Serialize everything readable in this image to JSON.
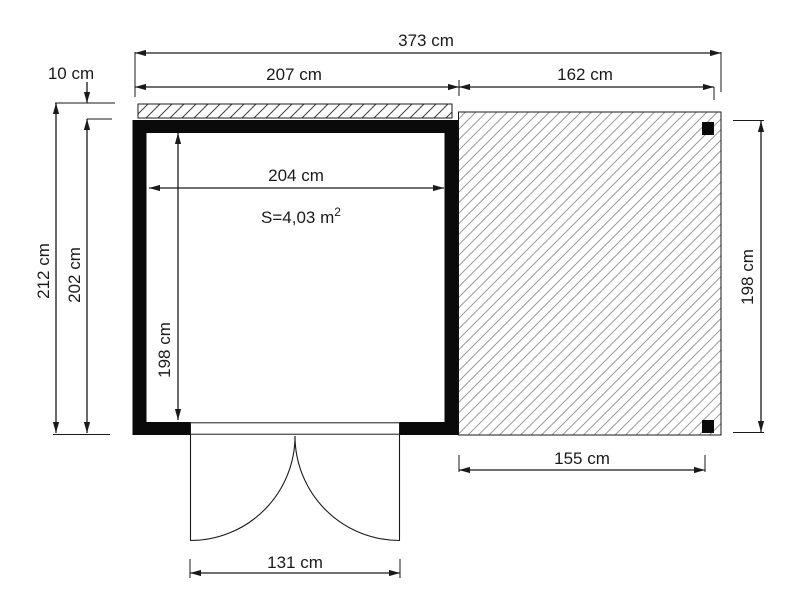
{
  "diagram": {
    "type": "floor-plan",
    "labels": {
      "total_width": "373 cm",
      "shed_width": "207 cm",
      "terrace_width": "162 cm",
      "roof_overhang": "10 cm",
      "total_depth": "212 cm",
      "shed_outer_depth": "202 cm",
      "inner_width": "204 cm",
      "inner_depth": "198 cm",
      "terrace_depth": "198 cm",
      "terrace_floor_width": "155 cm",
      "door_width": "131 cm",
      "area_base": "S=4,03 m",
      "area_exponent": "2"
    },
    "colors": {
      "background": "#ffffff",
      "line": "#1a1a1a",
      "wall_fill": "#0a0a0a",
      "overhang_hatch": "#3f3f3f",
      "terrace_hatch": "#9c9c9c"
    }
  }
}
